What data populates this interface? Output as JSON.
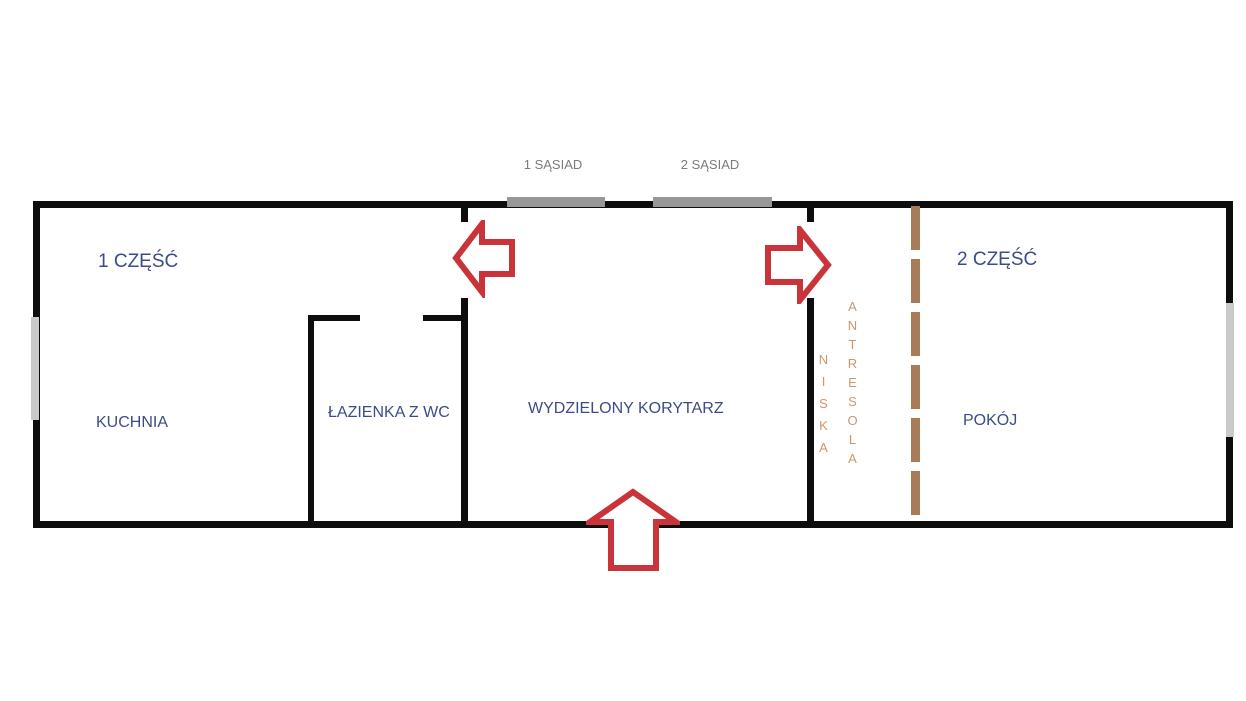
{
  "diagram": {
    "type": "floor-plan",
    "top_labels": {
      "neighbor1": "1 SĄSIAD",
      "neighbor2": "2 SĄSIAD"
    },
    "sections": {
      "part1": "1 CZĘŚĆ",
      "part2": "2 CZĘŚĆ"
    },
    "rooms": {
      "kitchen": "KUCHNIA",
      "bathroom": "ŁAZIENKA Z WC",
      "corridor": "WYDZIELONY KORYTARZ",
      "room": "POKÓJ"
    },
    "mezzanine": {
      "word1": "NISKA",
      "word2": "ANTRESOLA"
    },
    "colors": {
      "wall": "#0d0d0d",
      "section_text": "#3c4c88",
      "neighbor_text": "#7b7b7b",
      "door_bar": "#989898",
      "window": "#c9c9c9",
      "arrow_red": "#c9343a",
      "mezzanine_text": "#d0966a",
      "dash_line": "#a87c58"
    }
  }
}
